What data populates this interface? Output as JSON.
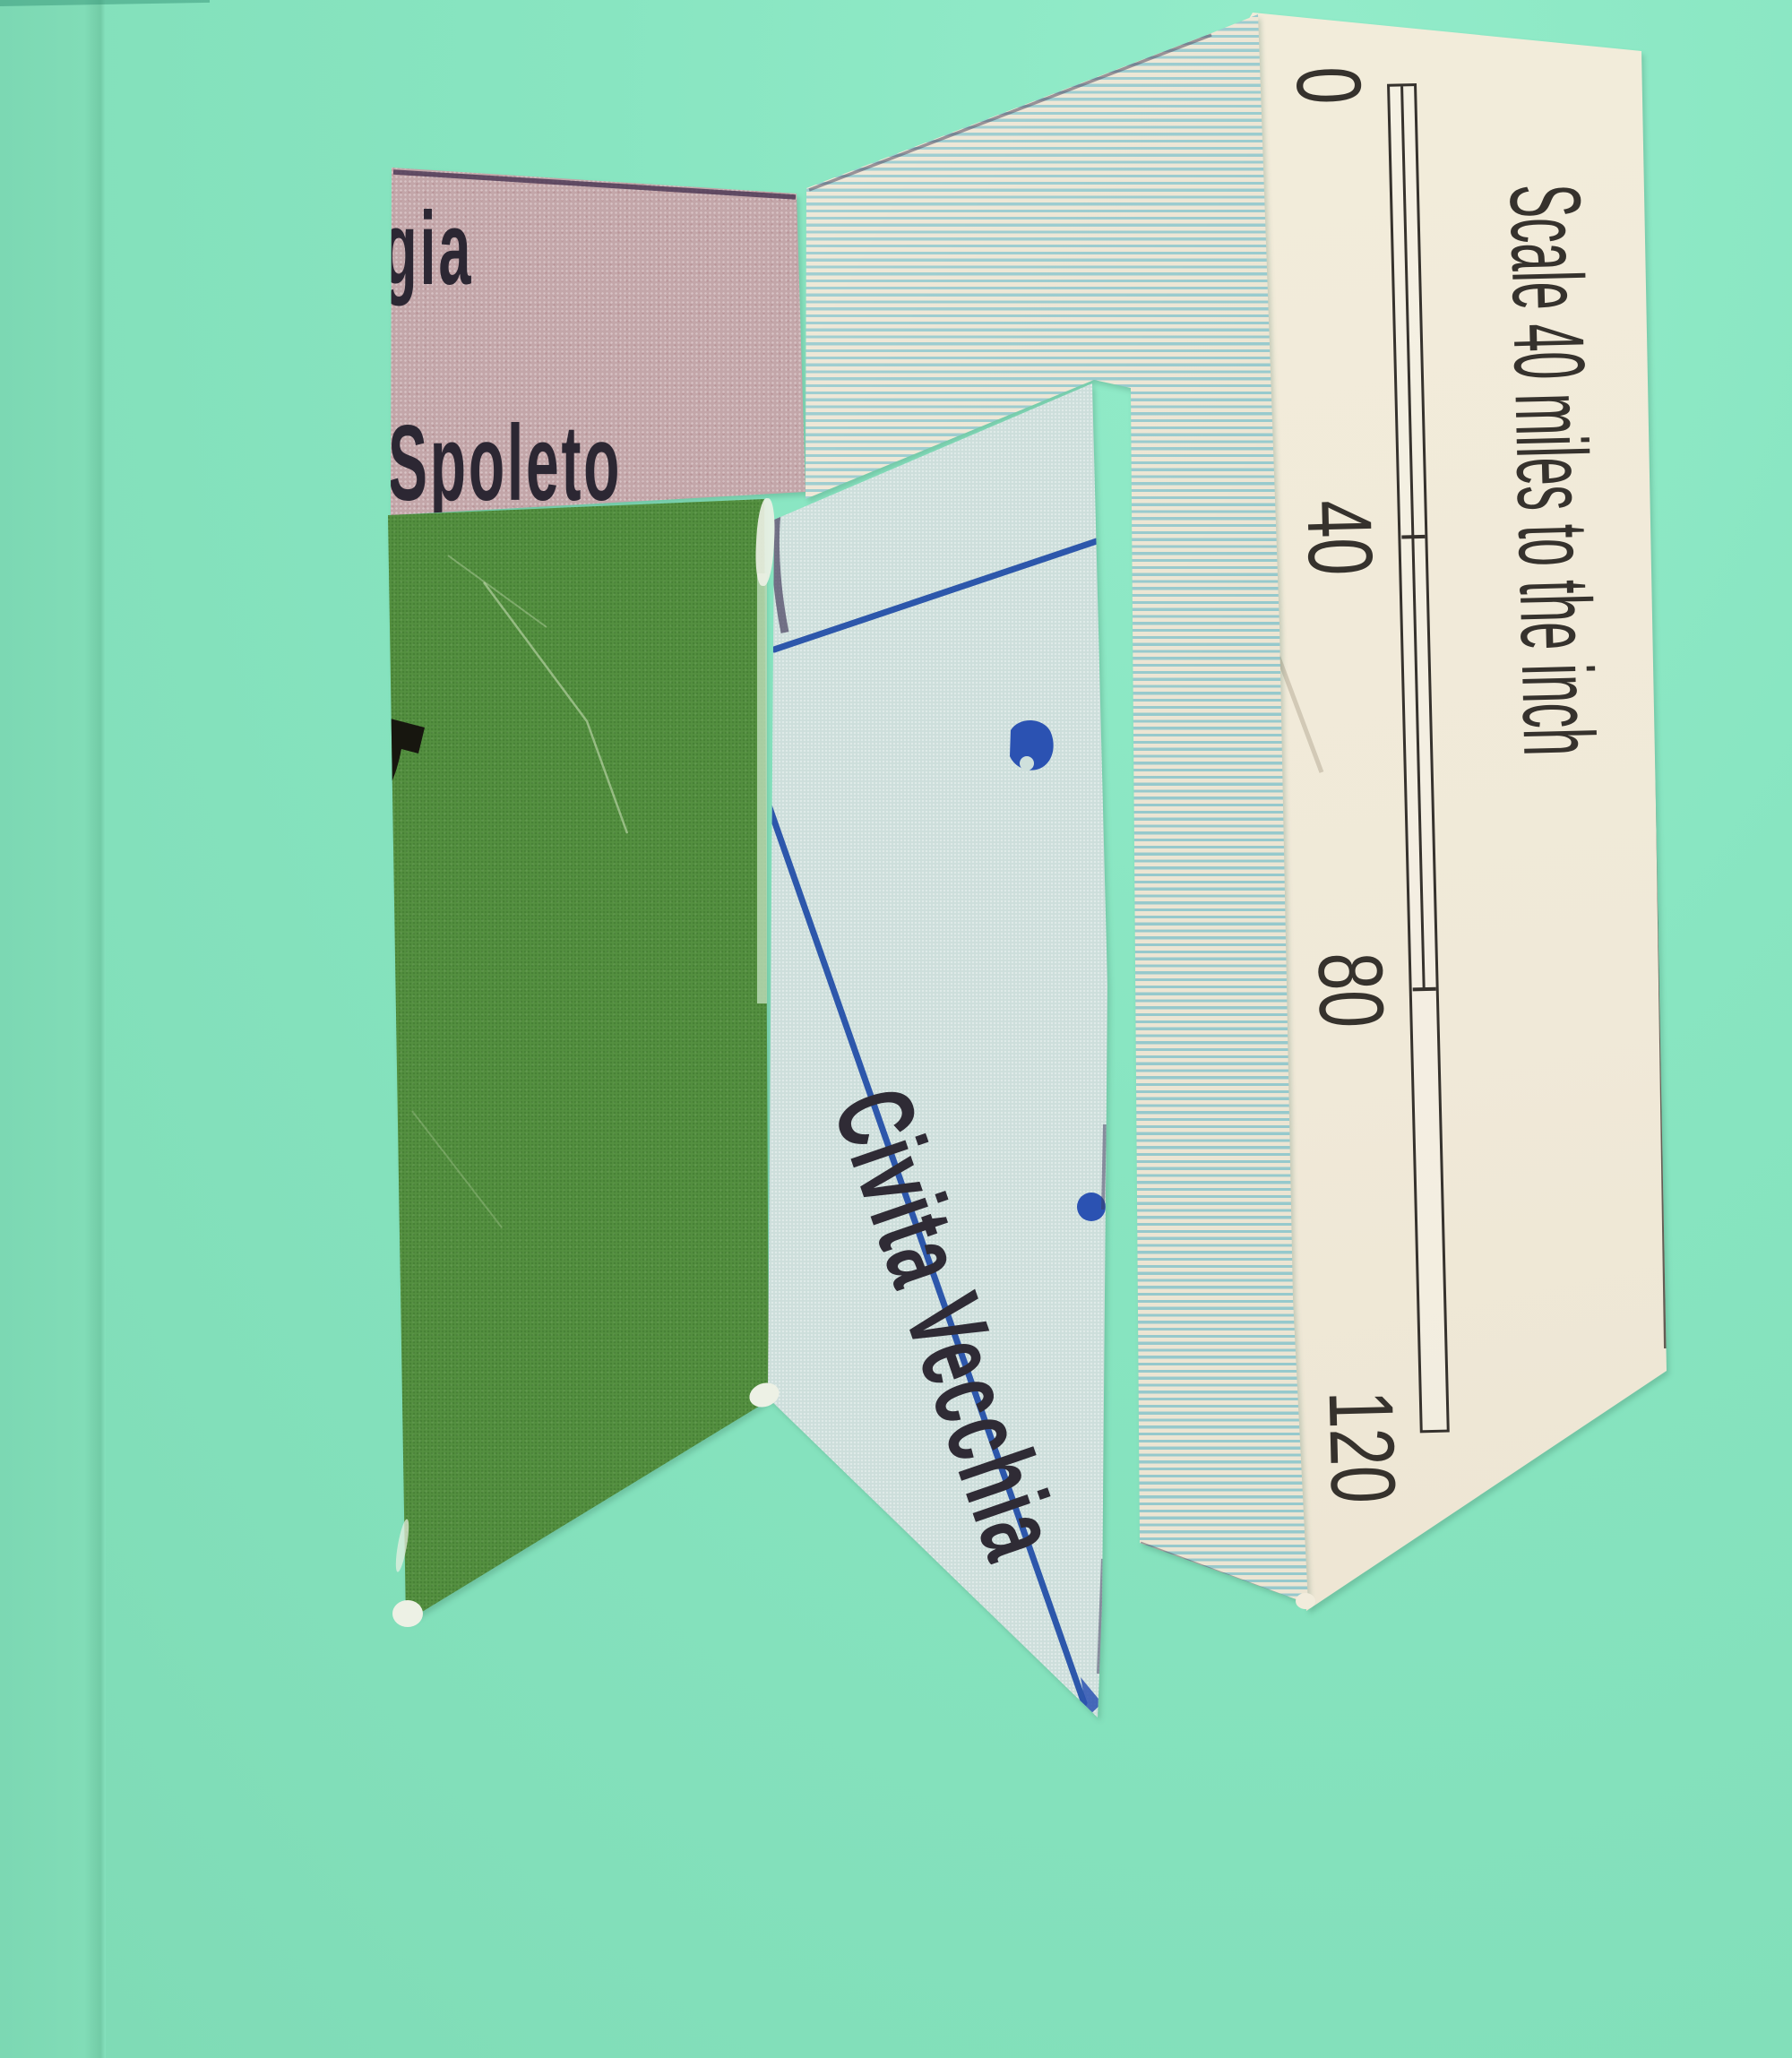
{
  "scene": {
    "type": "photograph of a paper map collage on a mint backing sheet",
    "background_color": "#88e5c1"
  },
  "fragments": {
    "pink": {
      "description": "dusty-pink map fragment",
      "paper_color": "#c3a6a9",
      "text_line1": "gia",
      "text_line2": "Spoleto"
    },
    "green": {
      "description": "solid green map fragment with partial black boundary glyph",
      "paper_color": "#549040"
    },
    "striped": {
      "description": "cream fragment printed with horizontal teal sea-stripes",
      "base_color": "#ece5d3",
      "stripe_color": "#96c9cc"
    },
    "sea": {
      "description": "pale blue sea-chart fragment with route lines and dots",
      "paper_color": "#cddedb",
      "line_color": "#2d57ab",
      "place_label": "Civita Vecchia"
    },
    "scale": {
      "description": "cream fragment with rotated map scale bar",
      "paper_color": "#f0e9d8",
      "ink_color": "#36322d",
      "caption": "Scale 40 miles to the inch",
      "tick_labels": [
        "0",
        "40",
        "80",
        "120"
      ]
    }
  }
}
